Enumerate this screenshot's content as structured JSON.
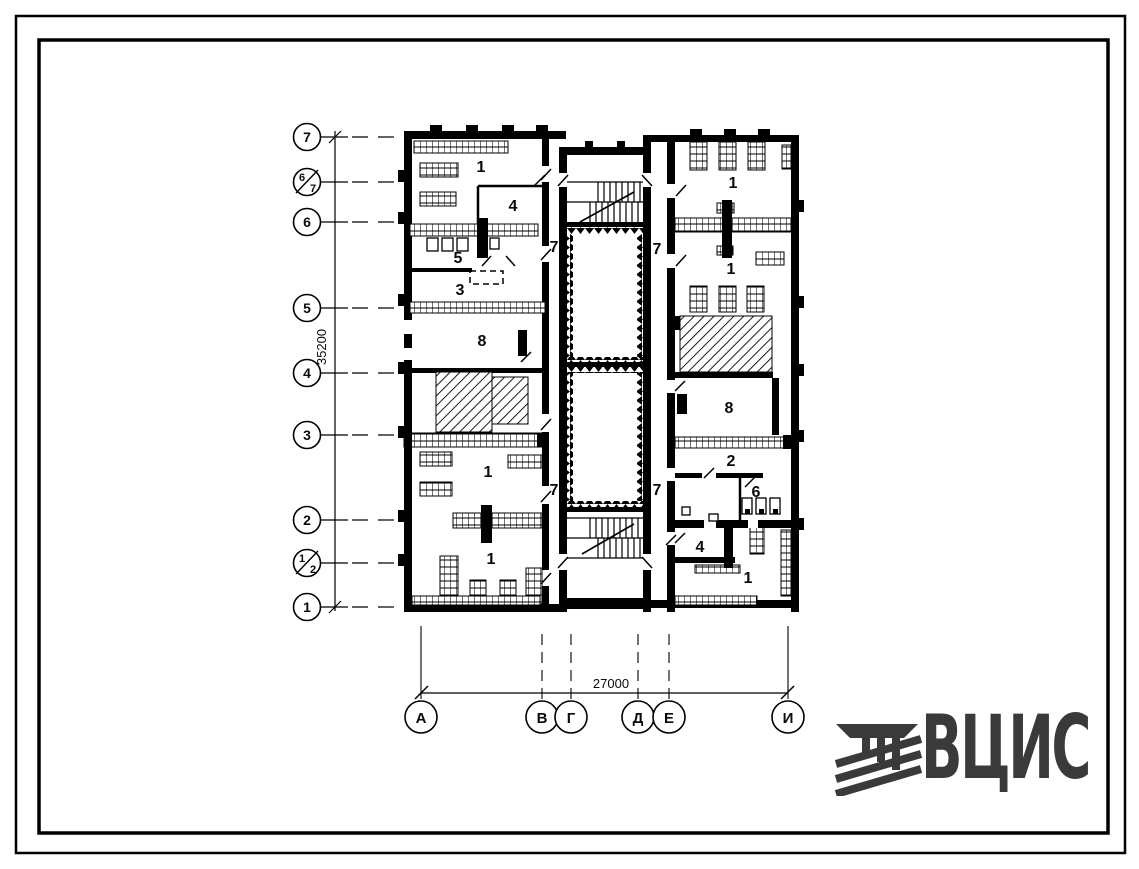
{
  "sheet": {
    "background": "#ffffff",
    "ink": "#000000"
  },
  "axes": {
    "left": [
      {
        "label": "7"
      },
      {
        "label": "6/7",
        "top": "6",
        "bottom": "7"
      },
      {
        "label": "6"
      },
      {
        "label": "5"
      },
      {
        "label": "4"
      },
      {
        "label": "3"
      },
      {
        "label": "2"
      },
      {
        "label": "1/2",
        "top": "1",
        "bottom": "2"
      },
      {
        "label": "1"
      }
    ],
    "left_dimension": "35200",
    "bottom": [
      {
        "label": "А"
      },
      {
        "label": "В"
      },
      {
        "label": "Г"
      },
      {
        "label": "Д"
      },
      {
        "label": "Е"
      },
      {
        "label": "И"
      }
    ],
    "bottom_dimension": "27000"
  },
  "rooms": {
    "left": [
      "1",
      "4",
      "5",
      "3",
      "8",
      "1",
      "1"
    ],
    "right": [
      "1",
      "1",
      "8",
      "2",
      "6",
      "4",
      "1"
    ],
    "corridor": [
      "7",
      "7",
      "7",
      "7"
    ]
  },
  "logo": {
    "text": "ВЦИС",
    "color": "#3a3a3c"
  }
}
